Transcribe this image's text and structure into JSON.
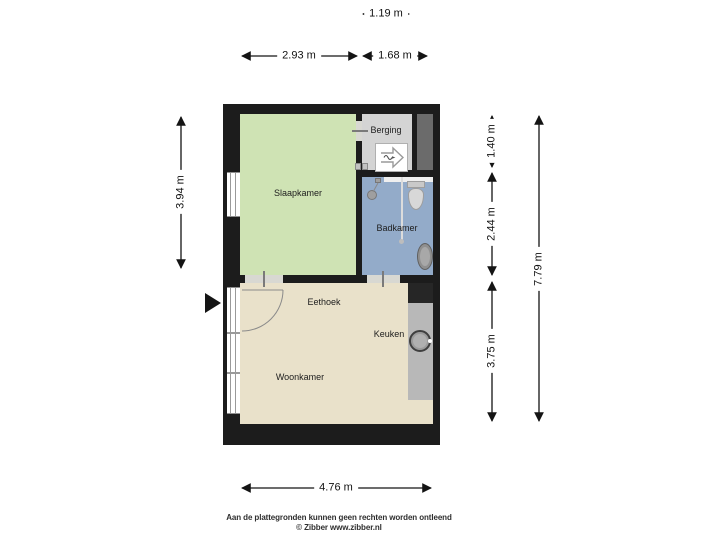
{
  "rooms": {
    "slaapkamer": "Slaapkamer",
    "berging": "Berging",
    "badkamer": "Badkamer",
    "eethoek": "Eethoek",
    "keuken": "Keuken",
    "woonkamer": "Woonkamer"
  },
  "dimensions": {
    "berging_width": "1.19 m",
    "slaapkamer_width": "2.93 m",
    "badkamer_width": "1.68 m",
    "slaapkamer_height": "3.94 m",
    "berging_height": "1.40 m",
    "badkamer_height": "2.44 m",
    "woonkamer_height": "3.75 m",
    "total_height": "7.79 m",
    "woonkamer_width": "4.76 m"
  },
  "footer": {
    "disclaimer": "Aan de plattegronden kunnen geen rechten worden ontleend",
    "credit": "© Zibber www.zibber.nl"
  },
  "colors": {
    "wall": "#1c1c1c",
    "slaapkamer": "#cfe3b4",
    "berging": "#d4d4d4",
    "shaft": "#6b6b6b",
    "badkamer": "#93abc9",
    "living": "#e9e1ca",
    "counter": "#b8b8b8",
    "counter_dark": "#262626",
    "background": "#ffffff"
  }
}
